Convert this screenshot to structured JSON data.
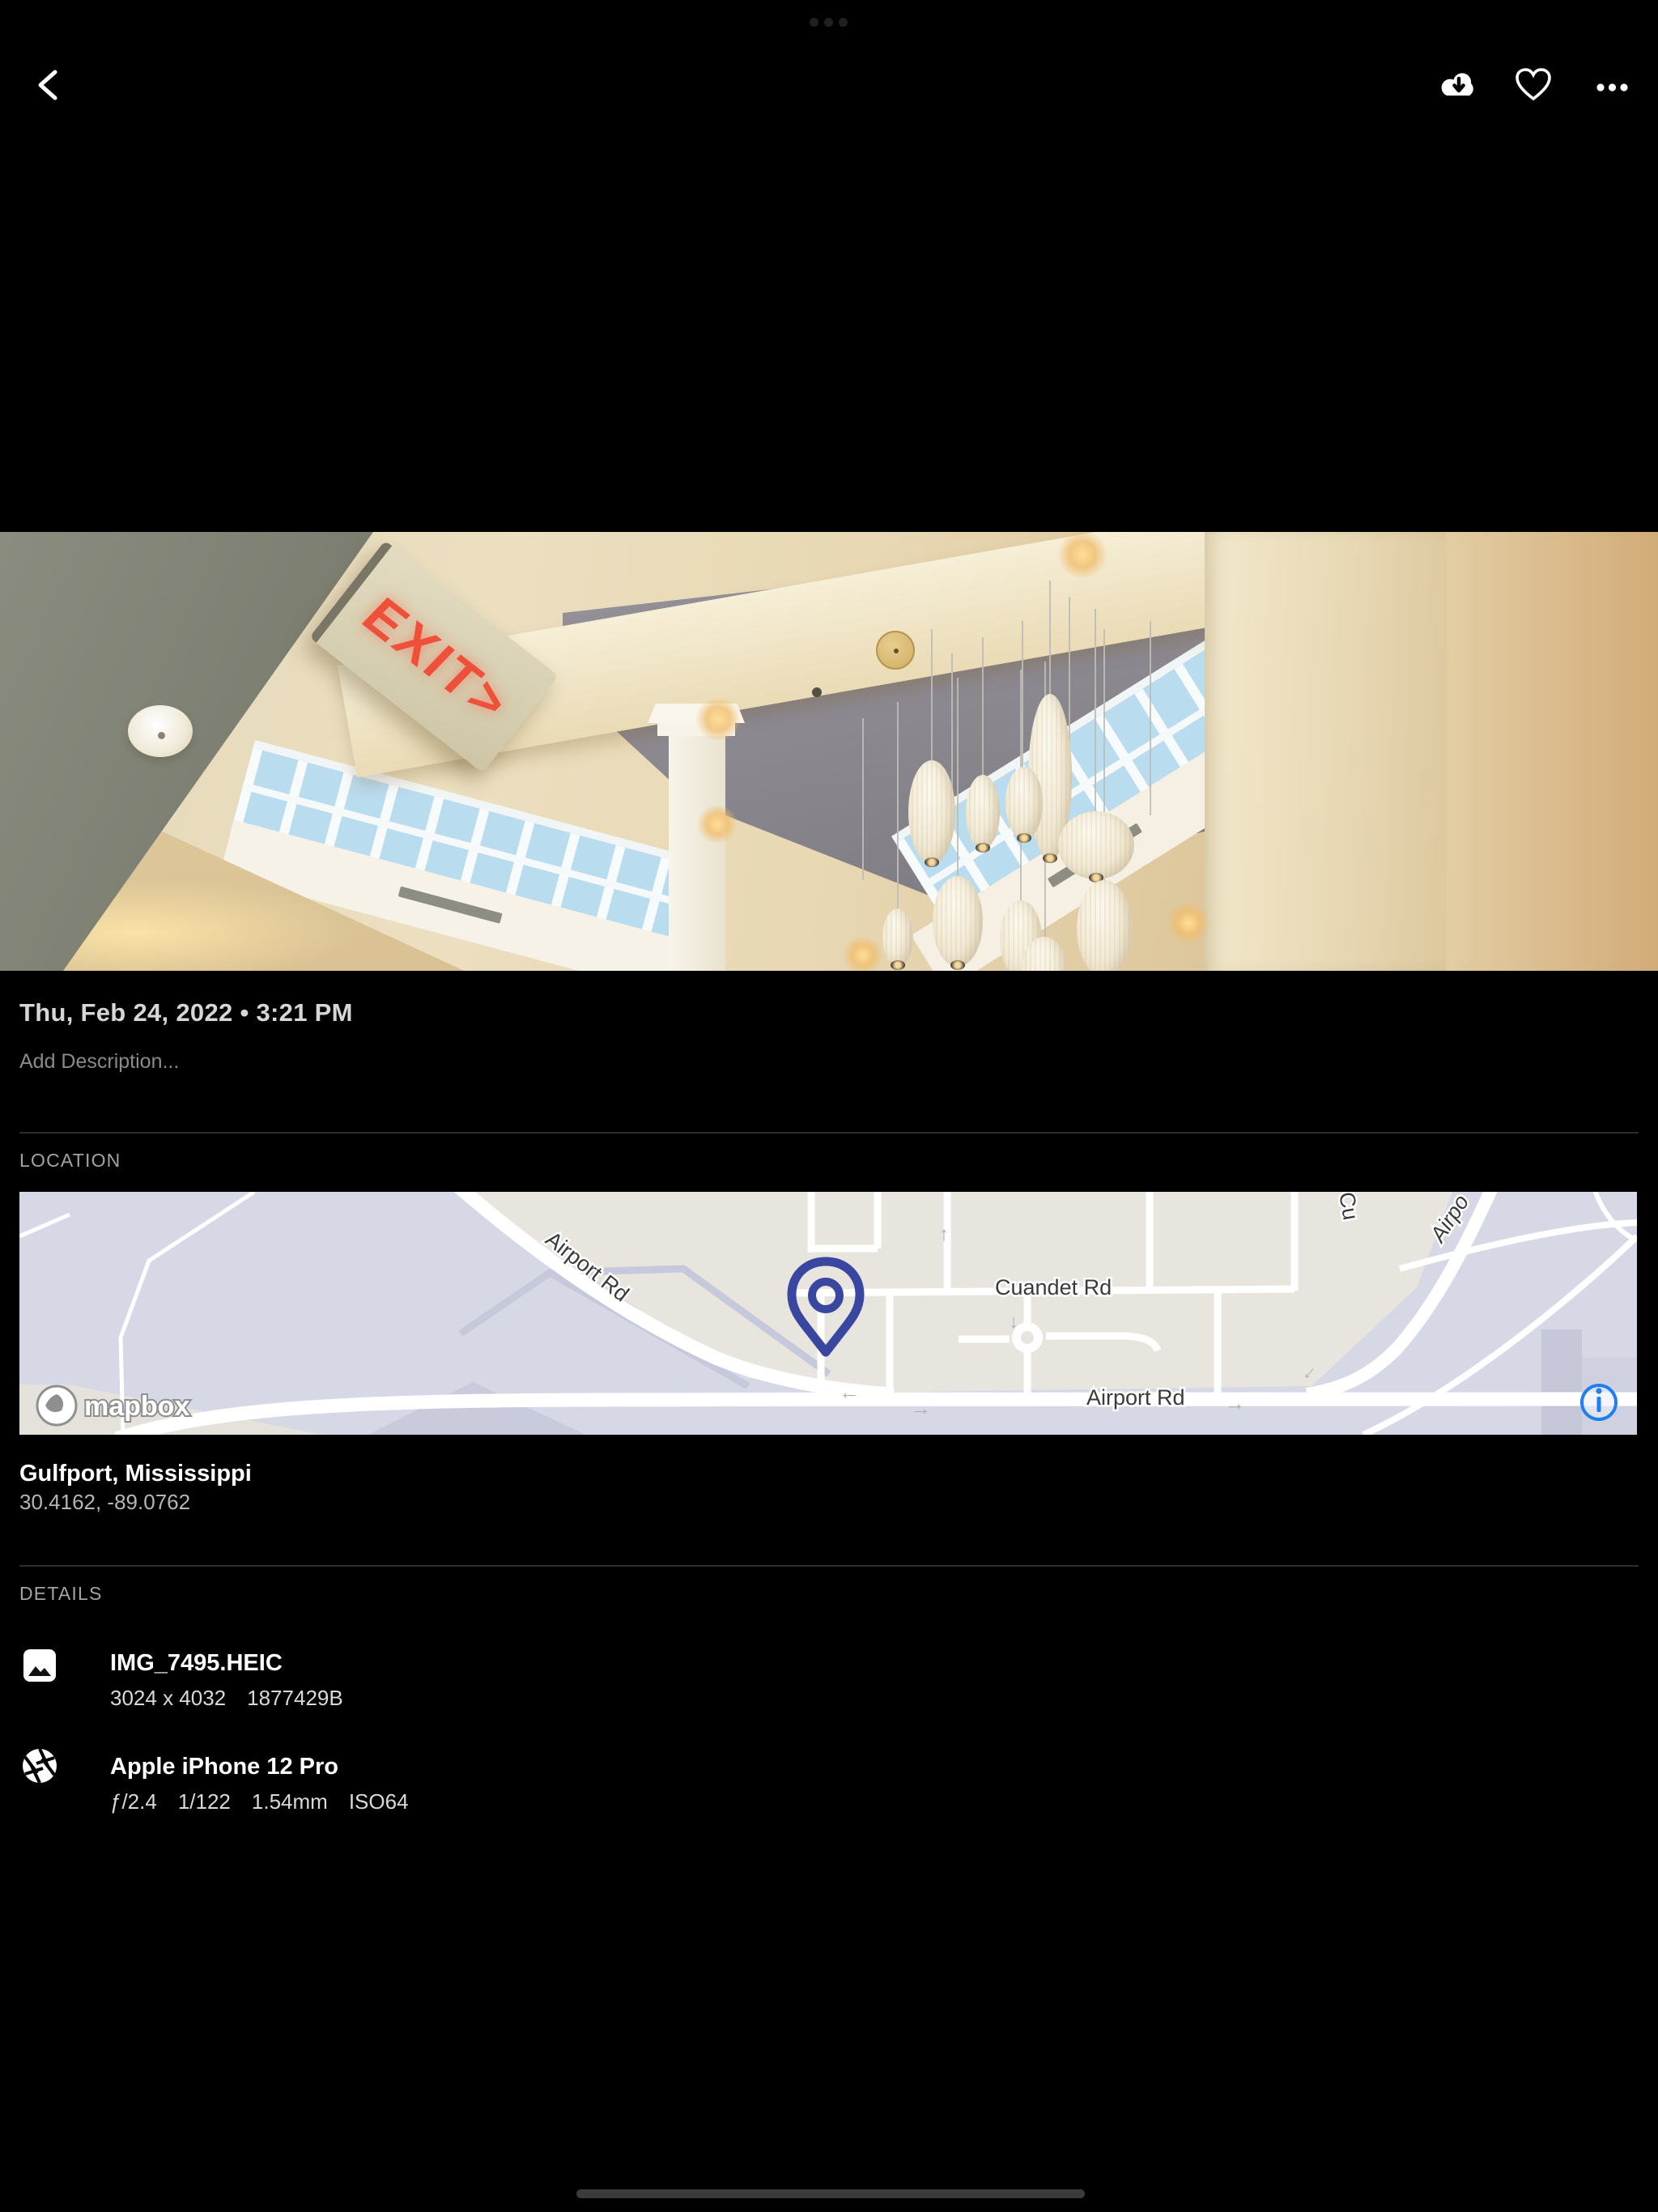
{
  "photo": {
    "datetime": "Thu, Feb 24, 2022 • 3:21 PM",
    "description_placeholder": "Add Description...",
    "exit_sign_text": "EXIT>"
  },
  "location": {
    "section_label": "LOCATION",
    "place": "Gulfport, Mississippi",
    "coordinates": "30.4162, -89.0762",
    "map": {
      "airport_rd": "Airport Rd",
      "cuandet_rd": "Cuandet Rd",
      "airport_rd2": "Airport Rd",
      "cu_partial": "Cu",
      "airpo_partial": "Airpo",
      "attribution": "mapbox"
    }
  },
  "details": {
    "section_label": "DETAILS",
    "file": {
      "name": "IMG_7495.HEIC",
      "dimensions": "3024 x 4032",
      "size": "1877429B"
    },
    "camera": {
      "name": "Apple iPhone 12 Pro",
      "aperture": "ƒ/2.4",
      "shutter": "1/122",
      "focal": "1.54mm",
      "iso": "ISO64"
    }
  },
  "colors": {
    "info_icon_blue": "#1f7ef0",
    "map_pin": "#3a47a1",
    "accent_text": "#d6d6d6"
  }
}
